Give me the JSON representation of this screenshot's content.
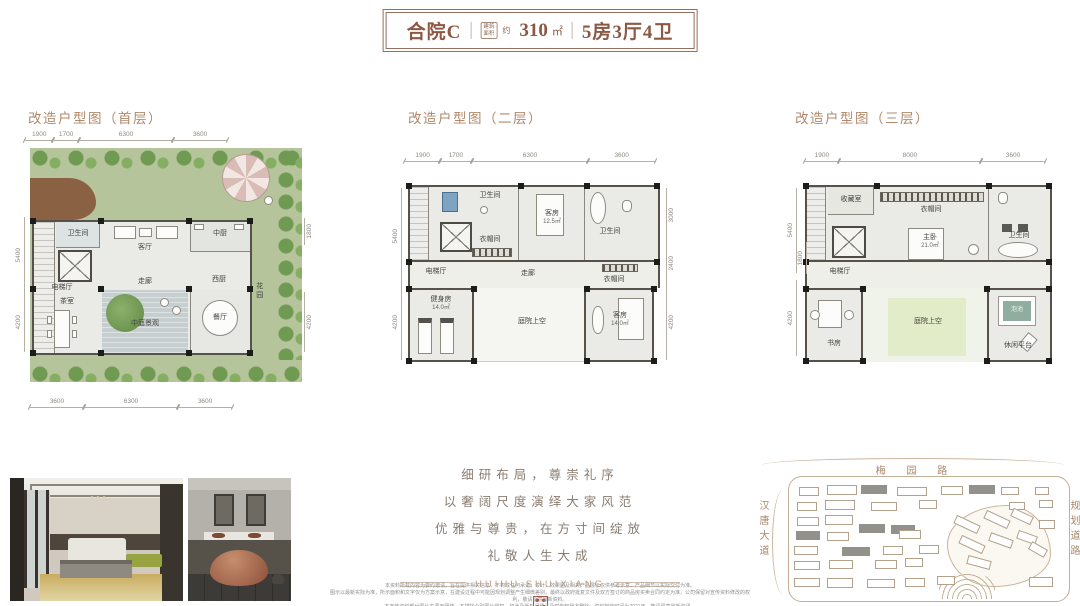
{
  "title": {
    "model": "合院C",
    "area_tag_line1": "建筑",
    "area_tag_line2": "面积",
    "area_approx": "约",
    "area_value": "310",
    "area_unit": "㎡",
    "layout": "5房3厅4卫"
  },
  "plans": [
    {
      "label": "改造户型图（首层）",
      "dims_top": [
        "1900",
        "1700",
        "6300",
        "3600"
      ],
      "dims_bottom": [
        "3600",
        "6300",
        "3600"
      ],
      "dims_left": [
        "5400",
        "4200"
      ],
      "dims_right": [
        "1800",
        "4200"
      ],
      "rooms": [
        {
          "name": "卫生间"
        },
        {
          "name": "客厅"
        },
        {
          "name": "中厨"
        },
        {
          "name": "电梯厅"
        },
        {
          "name": "走廊"
        },
        {
          "name": "茶室"
        },
        {
          "name": "中庭景观"
        },
        {
          "name": "餐厅"
        },
        {
          "name": "西厨"
        },
        {
          "name": "花园"
        }
      ]
    },
    {
      "label": "改造户型图（二层）",
      "dims_top": [
        "1900",
        "1700",
        "6300",
        "3600"
      ],
      "dims_left": [
        "5400",
        "4200"
      ],
      "dims_right": [
        "3000",
        "2400",
        "4200"
      ],
      "rooms": [
        {
          "name": "卫生间"
        },
        {
          "name": "衣帽间"
        },
        {
          "name": "客房",
          "area": "12.5㎡"
        },
        {
          "name": "卫生间"
        },
        {
          "name": "电梯厅"
        },
        {
          "name": "走廊"
        },
        {
          "name": "衣帽间"
        },
        {
          "name": "健身房",
          "area": "14.0㎡"
        },
        {
          "name": "庭院上空"
        },
        {
          "name": "客房",
          "area": "14.0㎡"
        }
      ]
    },
    {
      "label": "改造户型图（三层）",
      "dims_top": [
        "1900",
        "8000",
        "3600"
      ],
      "dims_left": [
        "5400",
        "1800",
        "4200"
      ],
      "rooms": [
        {
          "name": "收藏室"
        },
        {
          "name": "衣帽间"
        },
        {
          "name": "主卧",
          "area": "21.0㎡"
        },
        {
          "name": "卫生间"
        },
        {
          "name": "电梯厅"
        },
        {
          "name": "书房"
        },
        {
          "name": "庭院上空"
        },
        {
          "name": "泡池"
        },
        {
          "name": "休闲平台"
        }
      ]
    }
  ],
  "poem": {
    "lines": [
      "细研布局，尊崇礼序",
      "以奢阔尺度演绎大家风范",
      "优雅与尊贵，在方寸间绽放",
      "礼敬人生大成"
    ],
    "latin": "HUIHU SHUIXIANG"
  },
  "map": {
    "road_top": "梅 园 路",
    "road_left": "汉唐大道",
    "road_right": "规划道路"
  },
  "disclaimer": {
    "lines": [
      "本资料所载内容为要约邀请，旨在提供相关信息，不构成任何承诺；设计、效果图及相关产品展示仅供参考示意，产品细节以实际交付为准。",
      "图示以最新实际为准，所示面积和文字仅为方案示意，在建设过程中可能因规划调整产生细微差别，最终以政府批复文件及双方签订的商品房买卖合同约定为准，公司保留对宣传资料修改的权利，敬请留意最新资料。",
      "本宣传资料部分图片来源于网络，不排除个别图片侵权，如涉及版权问题请及时告知我方删除；资料制作时间为2021年，敬请留意最新资讯。"
    ]
  },
  "colors": {
    "brand_brown": "#8c5843",
    "header_tan": "#b1886b",
    "garden_green": "#b5c49b",
    "seal_red": "#b24a3c"
  }
}
